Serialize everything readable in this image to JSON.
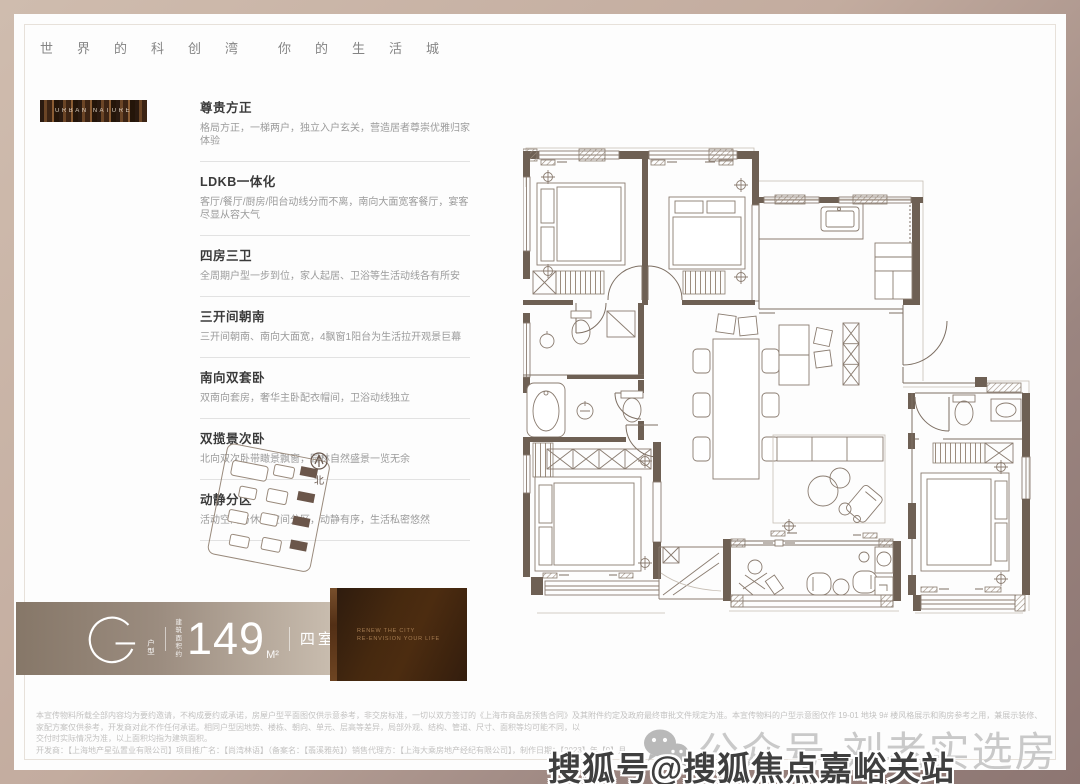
{
  "header": {
    "left": "世界的科创湾",
    "right": "你的生活城"
  },
  "badge": {
    "label": "URBAN NATURE"
  },
  "features": [
    {
      "title": "尊贵方正",
      "desc": "格局方正，一梯两户，独立入户玄关，营造居者尊崇优雅归家体验"
    },
    {
      "title": "LDKB一体化",
      "desc": "客厅/餐厅/厨房/阳台动线分而不离，南向大面宽客餐厅，宴客尽显从容大气"
    },
    {
      "title": "四房三卫",
      "desc": "全周期户型一步到位，家人起居、卫浴等生活动线各有所安"
    },
    {
      "title": "三开间朝南",
      "desc": "三开间朝南、南向大面宽，4飘窗1阳台为生活拉开观景巨幕"
    },
    {
      "title": "南向双套卧",
      "desc": "双南向套房，奢华主卧配衣帽间，卫浴动线独立"
    },
    {
      "title": "双揽景次卧",
      "desc": "北向双次卧带瞰景飘窗，园林自然盛景一览无余"
    },
    {
      "title": "动静分区",
      "desc": "活动空间与休憩空间分区，动静有序，生活私密悠然"
    }
  ],
  "site_plan": {
    "north_label": "北"
  },
  "unit": {
    "letter": "G",
    "letter_sub": "户型",
    "area_label_line1": "建筑",
    "area_label_line2": "面积约",
    "area_value": "149",
    "area_unit": "M²",
    "rooms": "四室两厅三卫"
  },
  "promo": {
    "line1": "RENEW THE CITY",
    "line2": "RE-ENVISION YOUR LIFE"
  },
  "disclaimer": {
    "line1": "本宣传物料所载全部内容均为要约邀请，不构成要约或承诺，房屋户型平面图仅供示意参考，非交房标准，一切以双方签订的《上海市商品房预售合同》及其附件约定及政府最终审批文件规定为准。本宣传物料的户型示意图仅作 19-01 地块 9# 楼风格展示和购房参考之用，兼展示装修、家配方案仅供参考，开发商对此不作任何承诺。相同户型因地势、楼栋、朝向、单元、层高等差异，局部外观、结构、管道、尺寸、面积等均可能不同，以",
    "line2": "交付时实际情况为准，以上面积均指为建筑面积。",
    "line3": "开发商：【上海地产星弘置业有限公司】项目推广名：【尚湾林语】（备案名：【翡溪雅苑】）销售代理方：【上海大乘房地产经纪有限公司】，制作日期：【2023】年【9】月。"
  },
  "watermarks": {
    "wechat": "公众号·刘老实选房",
    "sohu": "搜狐号@搜狐焦点嘉峪关站"
  },
  "colors": {
    "frame_light": "#cfbcae",
    "frame_dark": "#8d7672",
    "plan_line": "#7d6f63",
    "plan_wall": "#6e6054",
    "bar_left": "#867768",
    "bar_right": "#c8bcae",
    "promo_brown": "#46290f"
  }
}
